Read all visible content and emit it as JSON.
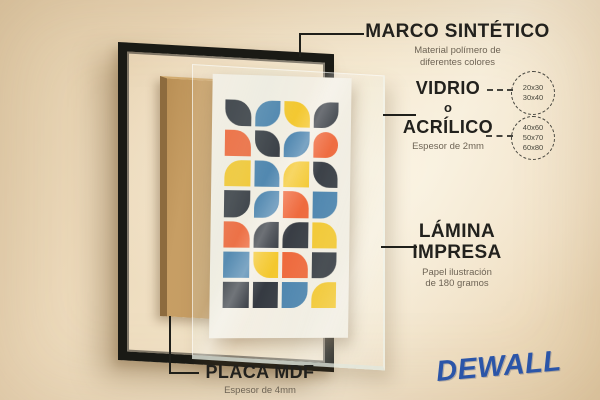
{
  "labels": {
    "marco": {
      "title": "MARCO SINTÉTICO",
      "desc_line1": "Material polímero de",
      "desc_line2": "diferentes colores"
    },
    "vidrio": {
      "title_line1": "VIDRIO",
      "title_line2": "o",
      "title_line3": "ACRÍLICO",
      "desc": "Espesor de 2mm",
      "sizes_circle_1": [
        "20x30",
        "30x40"
      ],
      "sizes_circle_2": [
        "40x60",
        "50x70",
        "60x80"
      ]
    },
    "lamina": {
      "title_line1": "LÁMINA",
      "title_line2": "IMPRESA",
      "desc_line1": "Papel ilustración",
      "desc_line2": "de 180 gramos"
    },
    "placa": {
      "title": "PLACA MDF",
      "desc": "Espesor de 4mm"
    }
  },
  "brand": {
    "name": "DEWALL",
    "color": "#2b55a8"
  },
  "artwork": {
    "poster_bg": "#f3eee2",
    "palette": {
      "dark": "#272c34",
      "blue": "#3d7aa8",
      "orange": "#ef5c2b",
      "yellow": "#f4c41e"
    },
    "cells": [
      {
        "c": "dark",
        "r": "0 65% 0 65%"
      },
      {
        "c": "blue",
        "r": "65% 0 65% 0"
      },
      {
        "c": "yellow",
        "r": "0 65% 0 65%"
      },
      {
        "c": "dark",
        "r": "65% 0 65% 0"
      },
      {
        "c": "orange",
        "r": "0 65% 0 0"
      },
      {
        "c": "dark",
        "r": "0 65% 0 65%"
      },
      {
        "c": "blue",
        "r": "65% 0 65% 0"
      },
      {
        "c": "orange",
        "r": "65% 65% 65% 0"
      },
      {
        "c": "yellow",
        "r": "65% 0 0 0"
      },
      {
        "c": "blue",
        "r": "0 65% 0 0"
      },
      {
        "c": "yellow",
        "r": "65% 0 0 0"
      },
      {
        "c": "dark",
        "r": "0 65% 0 65%"
      },
      {
        "c": "dark",
        "r": "0 0 65% 0"
      },
      {
        "c": "blue",
        "r": "65% 0 65% 0"
      },
      {
        "c": "orange",
        "r": "0 65% 0 0"
      },
      {
        "c": "blue",
        "r": "0 0 65% 0"
      },
      {
        "c": "orange",
        "r": "0 65% 0 0"
      },
      {
        "c": "dark",
        "r": "65% 0 0 0"
      },
      {
        "c": "dark",
        "r": "65% 0 0 0"
      },
      {
        "c": "yellow",
        "r": "0 65% 0 0"
      },
      {
        "c": "blue",
        "r": "0"
      },
      {
        "c": "yellow",
        "r": "0 0 0 65%"
      },
      {
        "c": "orange",
        "r": "0 65% 0 0"
      },
      {
        "c": "dark",
        "r": "0 0 65% 0"
      },
      {
        "c": "dark",
        "r": "0"
      },
      {
        "c": "dark",
        "r": "0"
      },
      {
        "c": "blue",
        "r": "0 0 65% 0"
      },
      {
        "c": "yellow",
        "r": "65% 0 0 0"
      }
    ]
  }
}
